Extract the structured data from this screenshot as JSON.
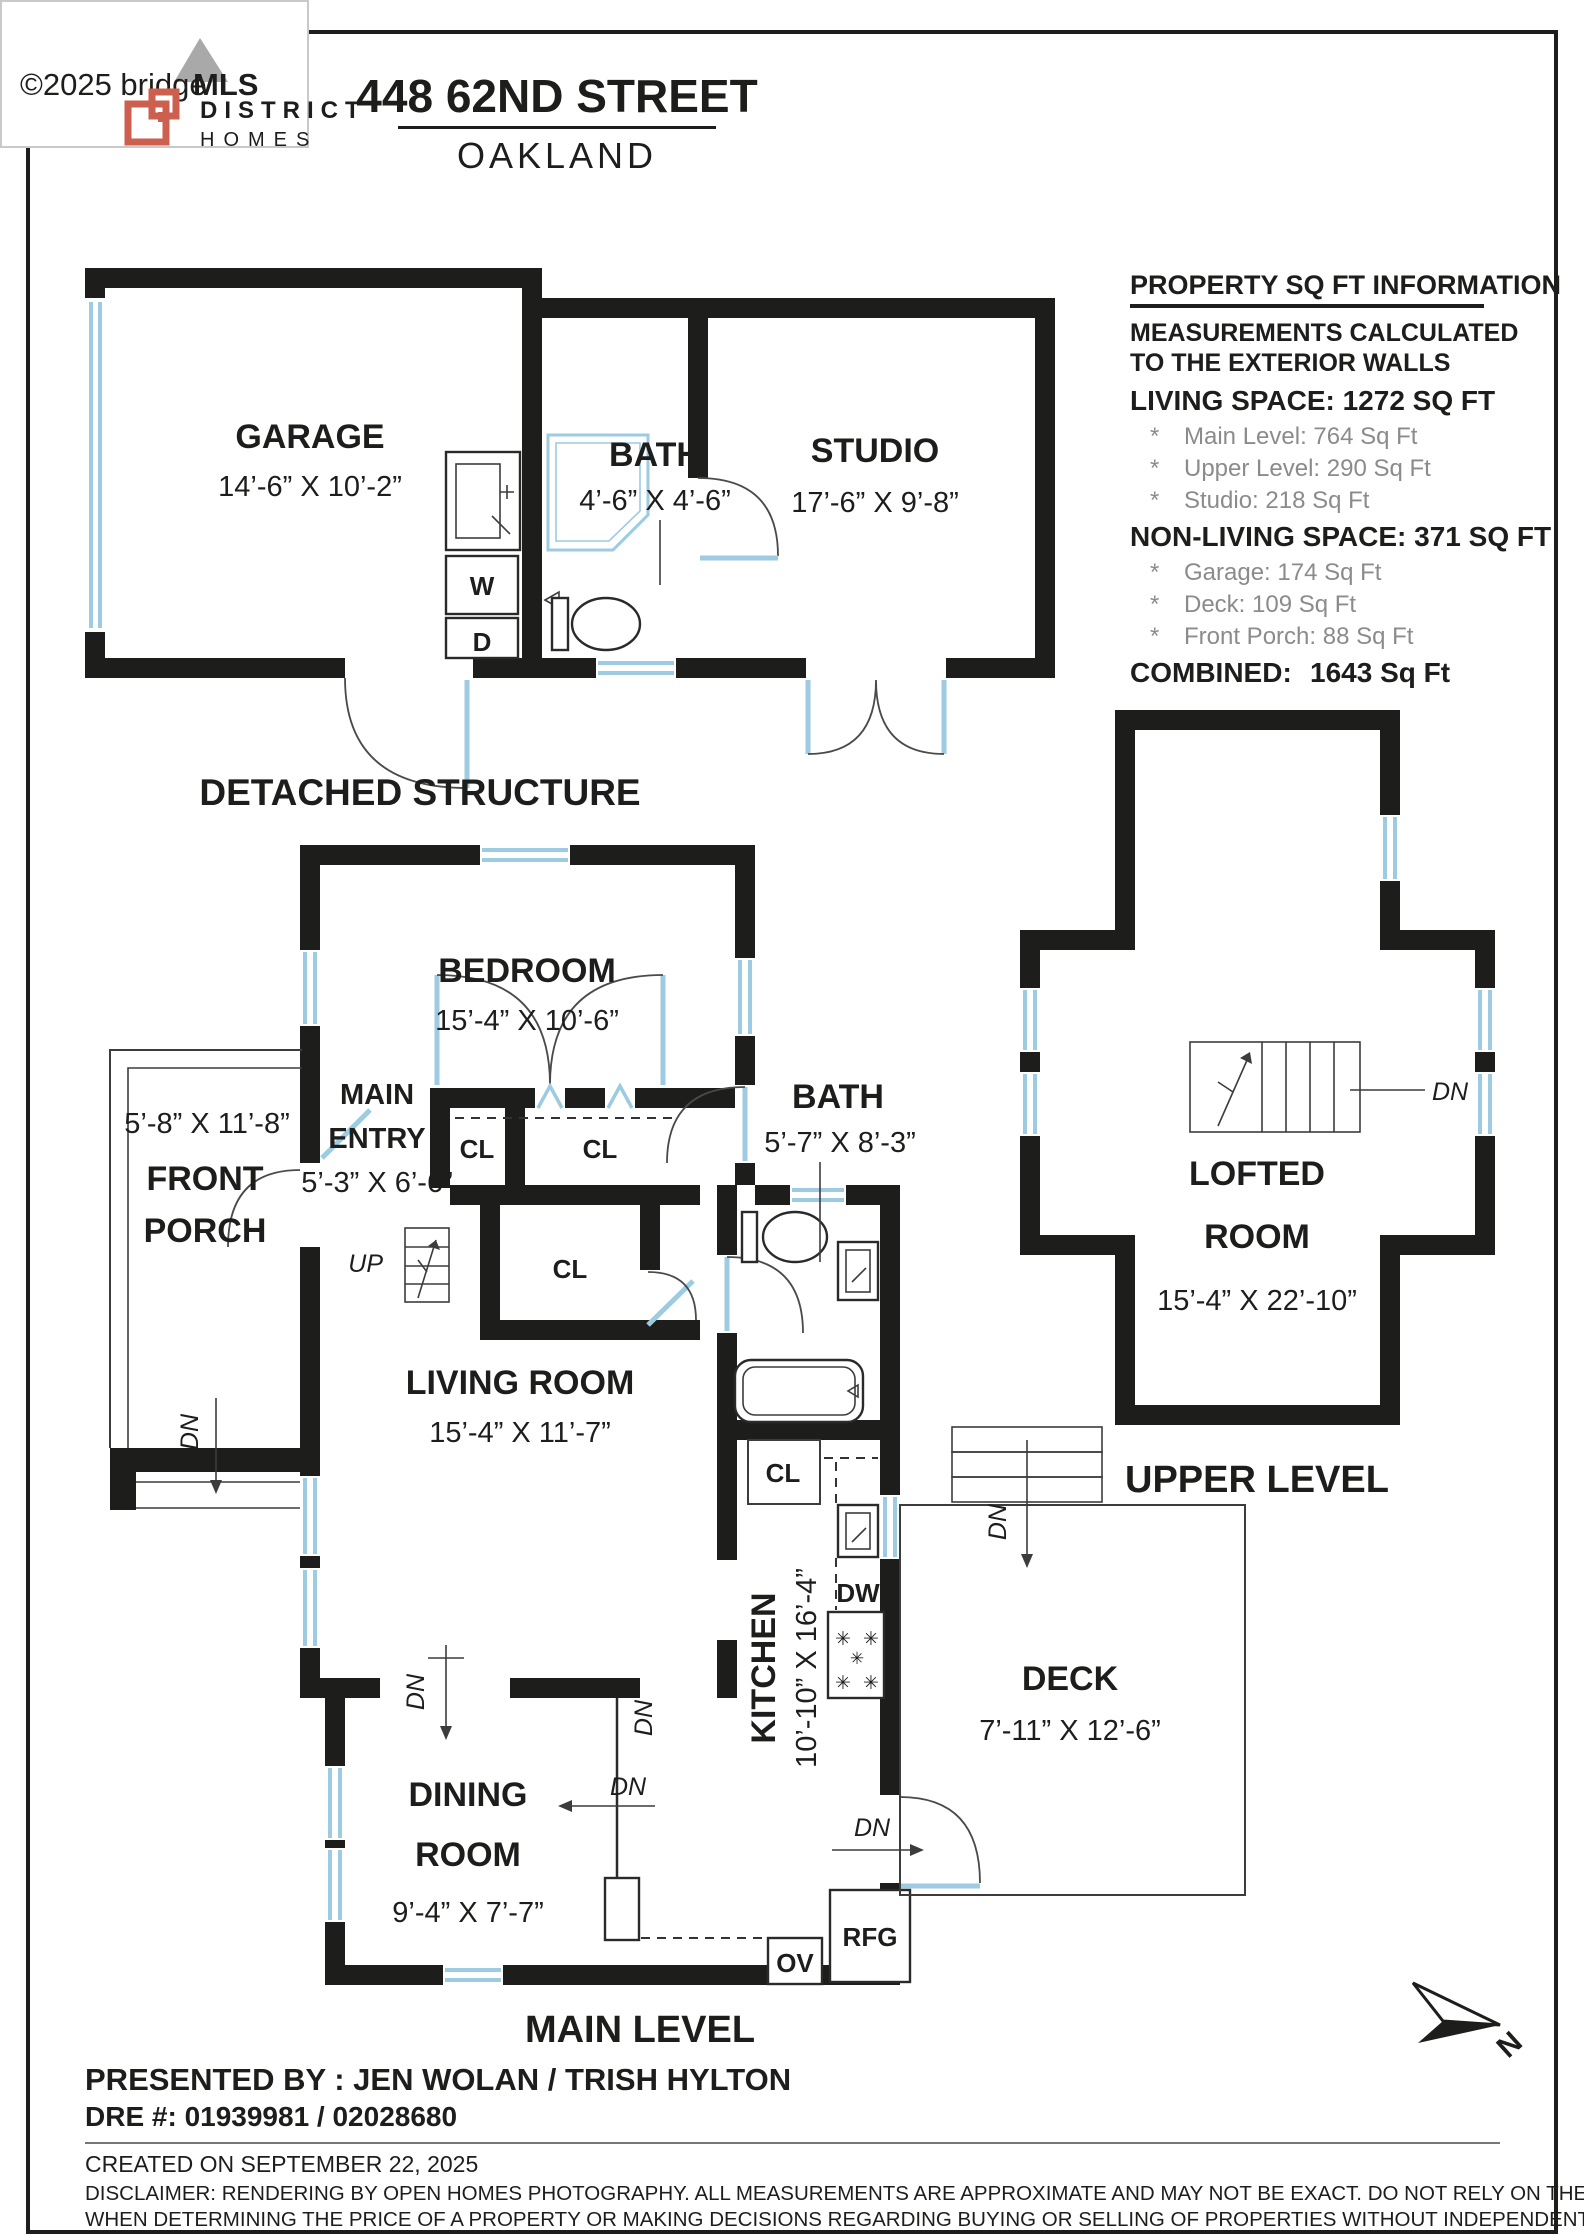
{
  "watermark": {
    "copyright": "©2025 bridge",
    "brand": "MLS"
  },
  "header": {
    "brand_line1": "DISTRICT",
    "brand_line2": "HOMES",
    "title": "448 62ND STREET",
    "city": "OAKLAND"
  },
  "info": {
    "title": "PROPERTY SQ FT INFORMATION",
    "note1": "MEASUREMENTS CALCULATED",
    "note2": "TO THE EXTERIOR WALLS",
    "living_title": "LIVING SPACE: 1272 SQ FT",
    "bullet": "*",
    "living_items": [
      {
        "t": "Main Level:   764 Sq Ft"
      },
      {
        "t": "Upper Level:   290 Sq Ft"
      },
      {
        "t": "Studio:   218 Sq Ft"
      }
    ],
    "nonliving_title": "NON-LIVING SPACE: 371 SQ FT",
    "nonliving_items": [
      {
        "t": "Garage:   174 Sq Ft"
      },
      {
        "t": "Deck:   109 Sq Ft"
      },
      {
        "t": "Front Porch:   88 Sq Ft"
      }
    ],
    "combined_label": "COMBINED:",
    "combined_value": "1643  Sq Ft"
  },
  "detached": {
    "caption": "DETACHED STRUCTURE",
    "garage_name": "GARAGE",
    "garage_dims": "14’-6” X 10’-2”",
    "bath_name": "BATH",
    "bath_dims": "4’-6” X 4’-6”",
    "studio_name": "STUDIO",
    "studio_dims": "17’-6” X 9’-8”",
    "washer": "W",
    "dryer": "D"
  },
  "main_level": {
    "caption": "MAIN LEVEL",
    "bedroom_name": "BEDROOM",
    "bedroom_dims": "15’-4” X 10’-6”",
    "entry_name1": "MAIN",
    "entry_name2": "ENTRY",
    "entry_dims": "5’-3” X 6’-6”",
    "porch_dims": "5’-8” X 11’-8”",
    "porch_name1": "FRONT",
    "porch_name2": "PORCH",
    "bath_name": "BATH",
    "bath_dims": "5’-7” X 8’-3”",
    "living_name": "LIVING ROOM",
    "living_dims": "15’-4” X 11’-7”",
    "dining_name1": "DINING",
    "dining_name2": "ROOM",
    "dining_dims": "9’-4” X 7’-7”",
    "kitchen_name": "KITCHEN",
    "kitchen_dims": "10’-10” X 16’-4”",
    "deck_name": "DECK",
    "deck_dims": "7’-11” X 12’-6”",
    "cl": "CL",
    "up": "UP",
    "dn": "DN",
    "dw": "DW",
    "ov": "OV",
    "rfg": "RFG"
  },
  "upper_level": {
    "caption": "UPPER LEVEL",
    "room_name1": "LOFTED",
    "room_name2": "ROOM",
    "room_dims": "15’-4” X 22’-10”",
    "dn": "DN"
  },
  "footer": {
    "presented": "PRESENTED BY : JEN WOLAN / TRISH HYLTON",
    "dre": "DRE #: 01939981 / 02028680",
    "created": "CREATED ON SEPTEMBER 22, 2025",
    "disclaimer1": "DISCLAIMER: RENDERING BY OPEN HOMES PHOTOGRAPHY. ALL MEASUREMENTS ARE APPROXIMATE AND MAY NOT BE EXACT. DO NOT RELY ON THE ACCURACY OF THIS FLOOR PLAN",
    "disclaimer2": "WHEN DETERMINING THE PRICE OF A PROPERTY OR MAKING DECISIONS REGARDING BUYING OR SELLING OF PROPERTIES WITHOUT INDEPENDENT VERIFICATION."
  },
  "compass": {
    "north": "N"
  },
  "colors": {
    "wall": "#1d1d1b",
    "window_blue": "#9ccbe2",
    "accent": "#cc5f4d",
    "gray_text": "#8b8b8b"
  }
}
